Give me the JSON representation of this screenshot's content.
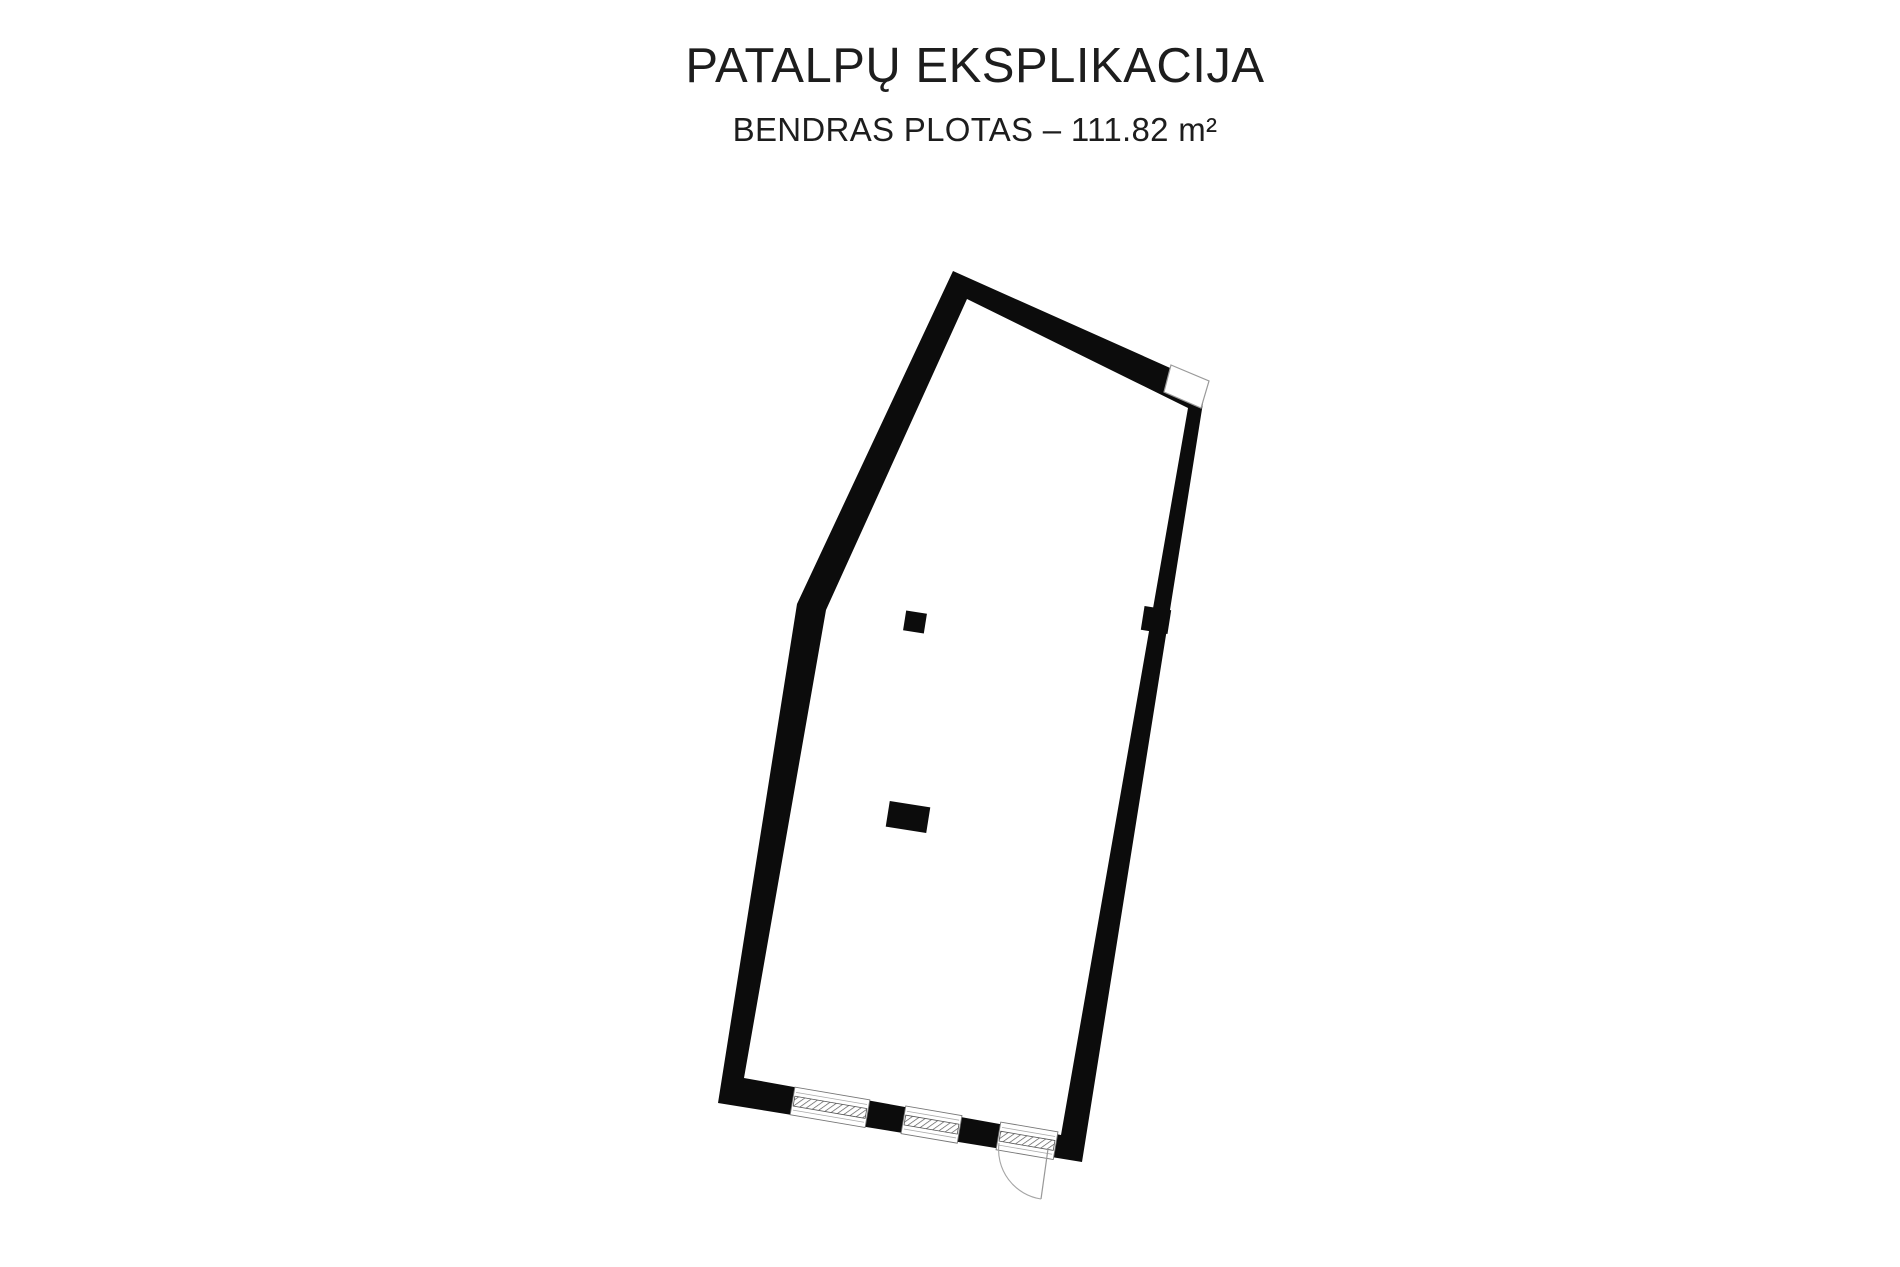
{
  "header": {
    "title": "PATALPŲ EKSPLIKACIJA",
    "subtitle": "BENDRAS PLOTAS – 111.82 m²"
  },
  "floor_plan": {
    "total_area_m2": "111.82",
    "wall_color": "#0c0c0c",
    "outline_color": "#8f8f8f",
    "window_line_color": "#9a9a9a",
    "hatch_color": "#5a5a5a",
    "outer_polygon": [
      [
        953,
        271
      ],
      [
        1206,
        384
      ],
      [
        1082,
        1162
      ],
      [
        718,
        1103
      ],
      [
        797,
        604
      ]
    ],
    "inner_polygon": [
      [
        967,
        299
      ],
      [
        1188,
        408
      ],
      [
        1061,
        1135
      ],
      [
        744,
        1078
      ],
      [
        826,
        610
      ]
    ],
    "corner_window_polygon": [
      [
        1171,
        365
      ],
      [
        1209,
        381
      ],
      [
        1201,
        408
      ],
      [
        1164,
        392
      ]
    ],
    "bottom_wall_angle_deg": 9.7,
    "openings": [
      {
        "name": "window-1",
        "cx": 830,
        "cy": 1107.3,
        "length": 76
      },
      {
        "name": "window-2",
        "cx": 931.5,
        "cy": 1124.6,
        "length": 57
      },
      {
        "name": "door-transom",
        "cx": 1027,
        "cy": 1140.8,
        "length": 58
      }
    ],
    "door": {
      "hinge": [
        1048,
        1149
      ],
      "leaf_end": [
        1041,
        1199
      ],
      "swing_start": [
        999,
        1143
      ],
      "radius": 50
    },
    "columns": [
      {
        "name": "column-small",
        "cx": 915,
        "cy": 622,
        "w": 21,
        "h": 20,
        "angle": 9
      },
      {
        "name": "column-wide",
        "cx": 908,
        "cy": 817,
        "w": 41,
        "h": 26,
        "angle": 9
      },
      {
        "name": "wall-pilaster",
        "cx": 1156,
        "cy": 620,
        "w": 27,
        "h": 24,
        "angle": 9
      }
    ]
  }
}
